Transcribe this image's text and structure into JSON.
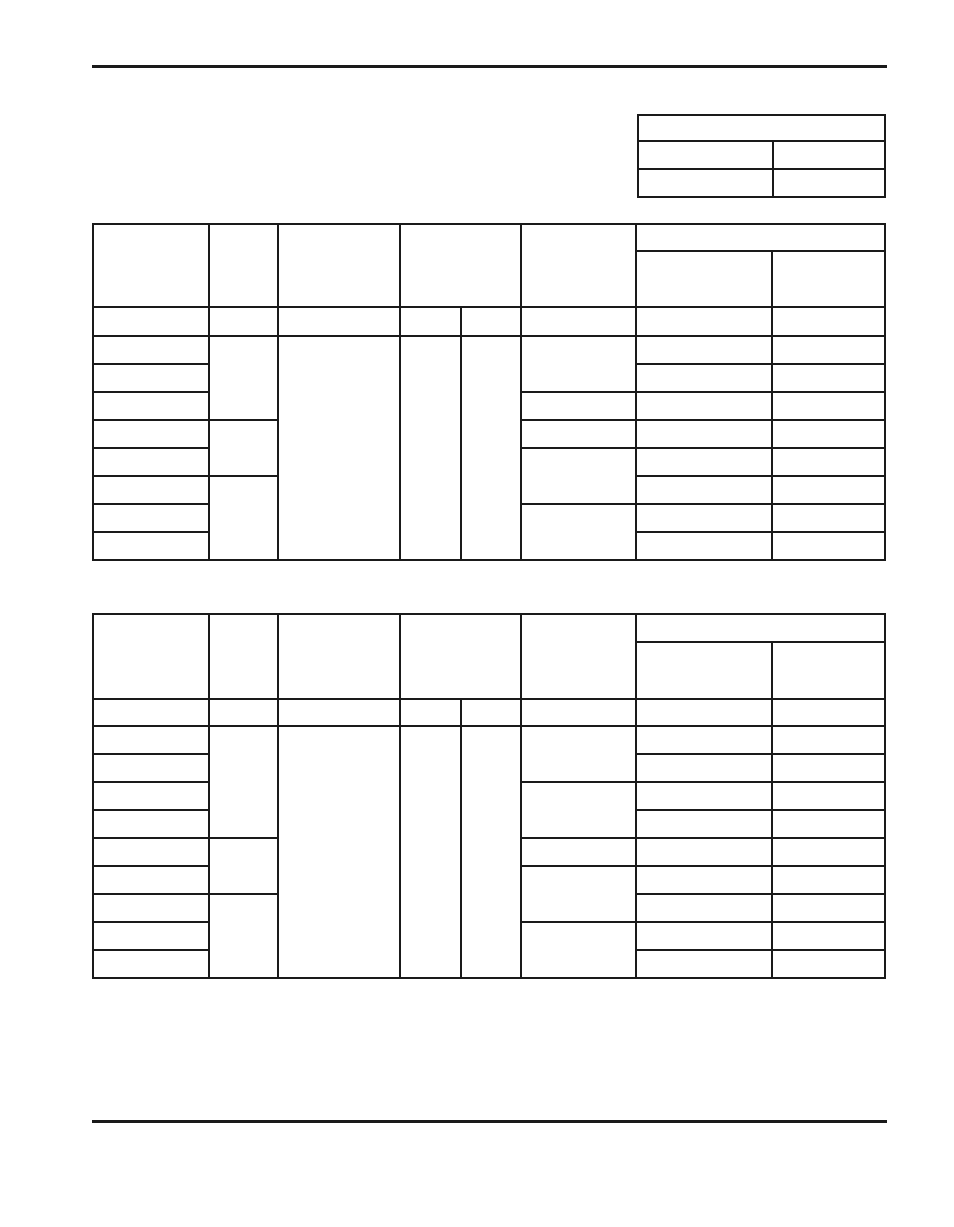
{
  "page": {
    "width": 954,
    "height": 1227,
    "background_color": "#ffffff",
    "line_color": "#1a1a1a",
    "visible_text": ""
  },
  "rules": [
    {
      "name": "top-rule",
      "x": 92,
      "y": 65,
      "width": 795,
      "height": 3
    },
    {
      "name": "bottom-rule",
      "x": 92,
      "y": 1120,
      "width": 795,
      "height": 3
    }
  ],
  "tables": [
    {
      "name": "header-info-table",
      "x": 637,
      "y": 114,
      "cols": [
        133,
        110
      ],
      "rows": [
        24,
        26,
        26
      ],
      "cells": [
        [
          1,
          1,
          1,
          2
        ],
        [
          2,
          1,
          1,
          1
        ],
        [
          2,
          2,
          1,
          1
        ],
        [
          3,
          1,
          1,
          1
        ],
        [
          3,
          2,
          1,
          1
        ]
      ]
    },
    {
      "name": "upper-table",
      "x": 92,
      "y": 223,
      "cols": [
        114,
        67,
        120,
        59,
        58,
        113,
        134,
        111
      ],
      "rows": [
        25,
        54,
        27,
        26,
        26,
        26,
        26,
        26,
        26,
        26,
        26
      ],
      "cells": [
        [
          1,
          1,
          2,
          1
        ],
        [
          1,
          2,
          2,
          1
        ],
        [
          1,
          3,
          2,
          1
        ],
        [
          1,
          4,
          2,
          2
        ],
        [
          1,
          6,
          2,
          1
        ],
        [
          1,
          7,
          1,
          2
        ],
        [
          2,
          7,
          1,
          1
        ],
        [
          2,
          8,
          1,
          1
        ],
        [
          3,
          1,
          1,
          1
        ],
        [
          3,
          2,
          1,
          1
        ],
        [
          3,
          3,
          1,
          1
        ],
        [
          3,
          4,
          1,
          1
        ],
        [
          3,
          5,
          1,
          1
        ],
        [
          3,
          6,
          1,
          1
        ],
        [
          3,
          7,
          1,
          1
        ],
        [
          3,
          8,
          1,
          1
        ],
        [
          4,
          1,
          1,
          1
        ],
        [
          5,
          1,
          1,
          1
        ],
        [
          6,
          1,
          1,
          1
        ],
        [
          7,
          1,
          1,
          1
        ],
        [
          8,
          1,
          1,
          1
        ],
        [
          9,
          1,
          1,
          1
        ],
        [
          10,
          1,
          1,
          1
        ],
        [
          11,
          1,
          1,
          1
        ],
        [
          4,
          2,
          3,
          1
        ],
        [
          7,
          2,
          2,
          1
        ],
        [
          9,
          2,
          3,
          1
        ],
        [
          4,
          3,
          8,
          1
        ],
        [
          4,
          4,
          8,
          1
        ],
        [
          4,
          5,
          8,
          1
        ],
        [
          4,
          6,
          2,
          1
        ],
        [
          6,
          6,
          1,
          1
        ],
        [
          7,
          6,
          1,
          1
        ],
        [
          8,
          6,
          2,
          1
        ],
        [
          10,
          6,
          2,
          1
        ],
        [
          4,
          7,
          1,
          1
        ],
        [
          5,
          7,
          1,
          1
        ],
        [
          6,
          7,
          1,
          1
        ],
        [
          7,
          7,
          1,
          1
        ],
        [
          8,
          7,
          1,
          1
        ],
        [
          9,
          7,
          1,
          1
        ],
        [
          10,
          7,
          1,
          1
        ],
        [
          11,
          7,
          1,
          1
        ],
        [
          4,
          8,
          1,
          1
        ],
        [
          5,
          8,
          1,
          1
        ],
        [
          6,
          8,
          1,
          1
        ],
        [
          7,
          8,
          1,
          1
        ],
        [
          8,
          8,
          1,
          1
        ],
        [
          9,
          8,
          1,
          1
        ],
        [
          10,
          8,
          1,
          1
        ],
        [
          11,
          8,
          1,
          1
        ]
      ]
    },
    {
      "name": "lower-table",
      "x": 92,
      "y": 613,
      "cols": [
        114,
        67,
        120,
        59,
        58,
        113,
        134,
        111
      ],
      "rows": [
        26,
        55,
        25,
        26,
        26,
        26,
        26,
        26,
        26,
        26,
        26,
        26
      ],
      "cells": [
        [
          1,
          1,
          2,
          1
        ],
        [
          1,
          2,
          2,
          1
        ],
        [
          1,
          3,
          2,
          1
        ],
        [
          1,
          4,
          2,
          2
        ],
        [
          1,
          6,
          2,
          1
        ],
        [
          1,
          7,
          1,
          2
        ],
        [
          2,
          7,
          1,
          1
        ],
        [
          2,
          8,
          1,
          1
        ],
        [
          3,
          1,
          1,
          1
        ],
        [
          3,
          2,
          1,
          1
        ],
        [
          3,
          3,
          1,
          1
        ],
        [
          3,
          4,
          1,
          1
        ],
        [
          3,
          5,
          1,
          1
        ],
        [
          3,
          6,
          1,
          1
        ],
        [
          3,
          7,
          1,
          1
        ],
        [
          3,
          8,
          1,
          1
        ],
        [
          4,
          1,
          1,
          1
        ],
        [
          5,
          1,
          1,
          1
        ],
        [
          6,
          1,
          1,
          1
        ],
        [
          7,
          1,
          1,
          1
        ],
        [
          8,
          1,
          1,
          1
        ],
        [
          9,
          1,
          1,
          1
        ],
        [
          10,
          1,
          1,
          1
        ],
        [
          11,
          1,
          1,
          1
        ],
        [
          12,
          1,
          1,
          1
        ],
        [
          4,
          2,
          4,
          1
        ],
        [
          8,
          2,
          2,
          1
        ],
        [
          10,
          2,
          3,
          1
        ],
        [
          4,
          3,
          9,
          1
        ],
        [
          4,
          4,
          9,
          1
        ],
        [
          4,
          5,
          9,
          1
        ],
        [
          4,
          6,
          2,
          1
        ],
        [
          6,
          6,
          2,
          1
        ],
        [
          8,
          6,
          1,
          1
        ],
        [
          9,
          6,
          2,
          1
        ],
        [
          11,
          6,
          2,
          1
        ],
        [
          4,
          7,
          1,
          1
        ],
        [
          5,
          7,
          1,
          1
        ],
        [
          6,
          7,
          1,
          1
        ],
        [
          7,
          7,
          1,
          1
        ],
        [
          8,
          7,
          1,
          1
        ],
        [
          9,
          7,
          1,
          1
        ],
        [
          10,
          7,
          1,
          1
        ],
        [
          11,
          7,
          1,
          1
        ],
        [
          12,
          7,
          1,
          1
        ],
        [
          4,
          8,
          1,
          1
        ],
        [
          5,
          8,
          1,
          1
        ],
        [
          6,
          8,
          1,
          1
        ],
        [
          7,
          8,
          1,
          1
        ],
        [
          8,
          8,
          1,
          1
        ],
        [
          9,
          8,
          1,
          1
        ],
        [
          10,
          8,
          1,
          1
        ],
        [
          11,
          8,
          1,
          1
        ],
        [
          12,
          8,
          1,
          1
        ]
      ]
    }
  ]
}
